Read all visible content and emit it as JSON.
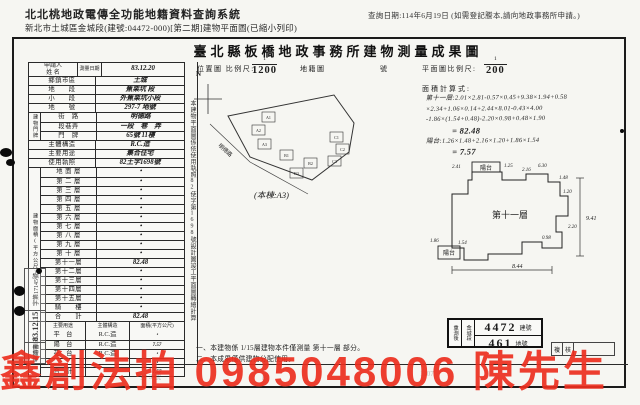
{
  "page": {
    "header_line1": "北北桃地政電傳全功能地籍資料查詢系統",
    "query_date": "查詢日期:114年6月19日 (如需登記謄本,請向地政事務所申請。)",
    "header_line2": "新北市土城區金城段(建號:04472-000)[第二期]建物平面圖(已縮小列印)",
    "title": "臺北縣板橋地政事務所建物測量成果圖"
  },
  "applicant": {
    "name_label": "申請人",
    "name_label2": "姓  名",
    "survey_date_label": "測量日期",
    "survey_date": "83.12.20"
  },
  "location": {
    "rows": [
      {
        "label": "鄉鎮市區",
        "value": "土城"
      },
      {
        "label": "地　　段",
        "value": "蕉栗坑 段"
      },
      {
        "label": "小　　段",
        "value": "外蕉栗坑小段"
      },
      {
        "label": "地　　號",
        "value": "297-7 地號"
      }
    ]
  },
  "address": {
    "side_label": "建物門牌",
    "rows": [
      {
        "label": "街　路",
        "value": "明德路"
      },
      {
        "label": "段巷弄",
        "value": "一段　巷　弄"
      },
      {
        "label": "門　牌",
        "value": "65號 11樓"
      }
    ]
  },
  "building": {
    "rows": [
      {
        "label": "主體構造",
        "value": "R.C.造"
      },
      {
        "label": "主要用途",
        "value": "集合住宅"
      },
      {
        "label": "使用執照",
        "value": "82土字1698號"
      }
    ]
  },
  "floors": {
    "side_label": "建物面積(平方公尺)",
    "rows": [
      {
        "label": "地 面 層",
        "value": "・"
      },
      {
        "label": "第 二 層",
        "value": "・"
      },
      {
        "label": "第 三 層",
        "value": "・"
      },
      {
        "label": "第 四 層",
        "value": "・"
      },
      {
        "label": "第 五 層",
        "value": "・"
      },
      {
        "label": "第 六 層",
        "value": "・"
      },
      {
        "label": "第 七 層",
        "value": "・"
      },
      {
        "label": "第 八 層",
        "value": "・"
      },
      {
        "label": "第 九 層",
        "value": "・"
      },
      {
        "label": "第 十 層",
        "value": "・"
      },
      {
        "label": "第十一層",
        "value": "82.48"
      },
      {
        "label": "第十二層",
        "value": "・"
      },
      {
        "label": "第十三層",
        "value": "・"
      },
      {
        "label": "第十四層",
        "value": "・"
      },
      {
        "label": "第十五層",
        "value": "・"
      },
      {
        "label": "騎　　樓",
        "value": "・"
      },
      {
        "label": "合　　計",
        "value": "82.48"
      }
    ]
  },
  "annex": {
    "side_label": "附屬建物",
    "headers": [
      "主要用途",
      "主體構造",
      "面積(平方公尺)"
    ],
    "rows": [
      {
        "use": "平　台",
        "structure": "R.C.造",
        "area": "・"
      },
      {
        "use": "陽　台",
        "structure": "R.C.造",
        "area": "7.57"
      },
      {
        "use": "花　台",
        "structure": "R.C.造",
        "area": "・"
      },
      {
        "use": "",
        "structure": "",
        "area": "・"
      },
      {
        "use": "合　計",
        "structure": "",
        "area": "7.57"
      }
    ]
  },
  "sidenote": {
    "text": "本建物平面圖係依使用執照82使字第1698號設計圖竣工平面圖轉繪計算"
  },
  "scales": {
    "loc_label": "位置圖 比例尺:",
    "loc_num": "1",
    "loc_den": "1200",
    "cadastral": "地籍圖",
    "sheet": "號",
    "plan_label": "平面圖比例尺:",
    "plan_num": "1",
    "plan_den": "200",
    "calc_label": "面積計算式:"
  },
  "calc": {
    "lines": [
      "第十一層:2.01×2.81-0.57×0.45+9.38×1.94+0.58",
      "×2.34+1.06×0.14+2.44×8.01-0.43×4.00",
      "-1.86×(1.54+0.48)-2.20×0.98+0.48×1.90",
      "= 82.48",
      "陽台:1.26×1.48+2.16×1.20+1.86×1.54",
      "= 7.57"
    ]
  },
  "map": {
    "north": "N",
    "road": "明德路",
    "caption": "(本棟:A3)",
    "blocks": [
      "A1",
      "A2",
      "A3",
      "B1",
      "B2",
      "B3",
      "C1",
      "C2",
      "C3"
    ]
  },
  "plan": {
    "room": "第十一層",
    "balcony_top": "陽台",
    "balcony_bottom": "陽台",
    "dim_right": "9.41",
    "dim_bottom": "8.44",
    "small": [
      "2.41",
      "1.25",
      "2.16",
      "6.30",
      "1.48",
      "1.20",
      "2.20",
      "0.98",
      "1.86",
      "1.54"
    ]
  },
  "result_box": {
    "left_top": "重測後",
    "left_bottom": "金城段",
    "build_no": "4472",
    "build_unit": "建號",
    "land_no": "461",
    "land_unit": "地號"
  },
  "notes": {
    "n1": "一、本建物係 1/15層建物本件僅測量 第十一層 部分。",
    "n2": "二、本成果僅供建物分配使用。"
  },
  "review": {
    "c1": "複",
    "c2": "核"
  },
  "receipt": {
    "a": "申請書",
    "b": "83.12.15",
    "c": "字第17145號"
  },
  "faint": {
    "f1": "第  3 號",
    "f2": "股",
    "f3": "7",
    "f4": "1107"
  },
  "watermark": {
    "text": "鑫創法拍 0985048006 陳先生",
    "color": "#eb2e1e"
  }
}
